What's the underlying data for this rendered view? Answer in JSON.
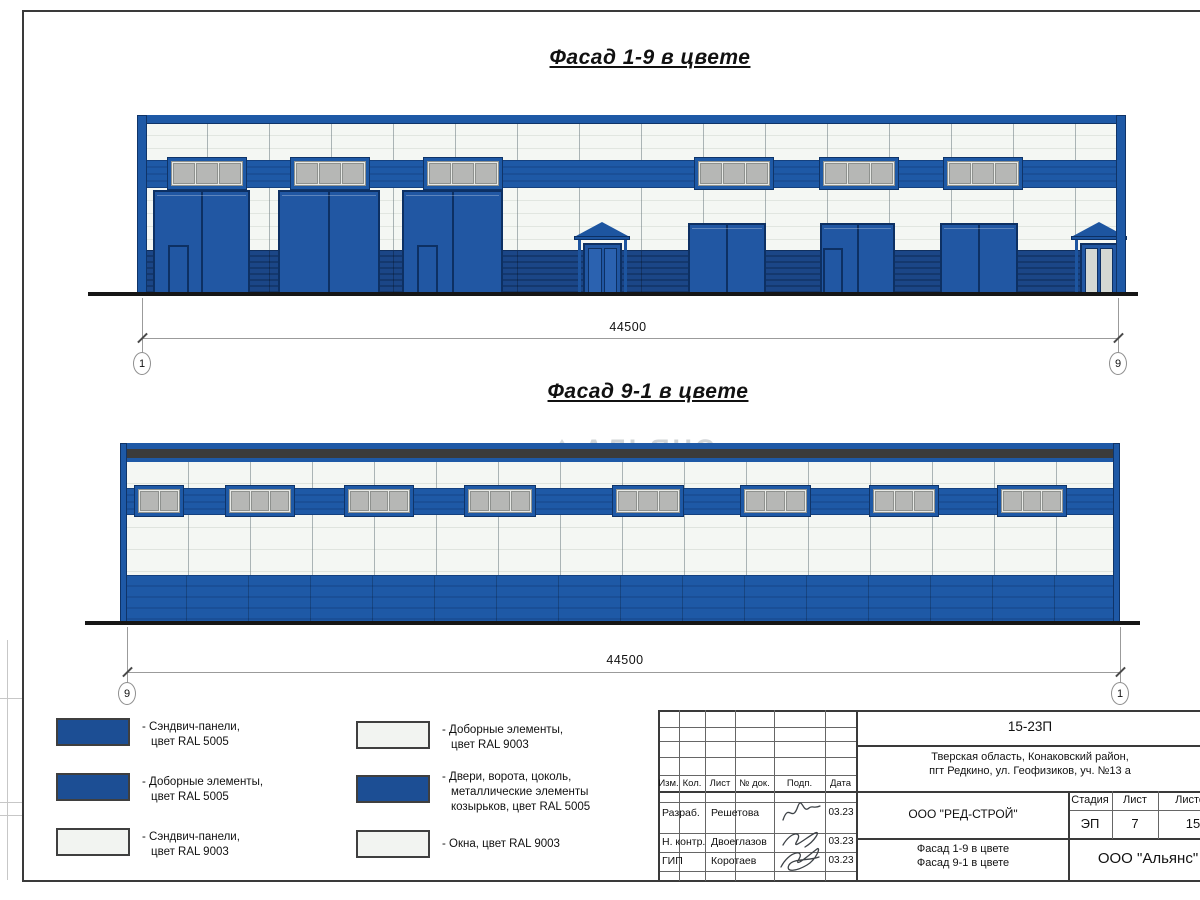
{
  "titles": {
    "facade19": "Фасад 1-9 в цвете",
    "facade91": "Фасад 9-1 в цвете"
  },
  "dimensions": {
    "facade19": {
      "value": "44500",
      "left_axis": "1",
      "right_axis": "9"
    },
    "facade91": {
      "value": "44500",
      "left_axis": "9",
      "right_axis": "1"
    }
  },
  "watermark": {
    "text": "АЛЬЯНС"
  },
  "colors": {
    "facade_blue": "#1e59a6",
    "door_blue": "#2157a3",
    "base_blue": "#1b4687",
    "legend_blue": "#1c4e94",
    "panel_white": "#f2f4f1",
    "window_gray": "#b6b7b5",
    "dark_band": "#3b3b3b"
  },
  "legend": {
    "items": [
      {
        "color": "#1c4e94",
        "lines": [
          "- Сэндвич-панели,",
          "цвет RAL 5005"
        ]
      },
      {
        "color": "#1c4e94",
        "lines": [
          "- Доборные элементы,",
          "цвет RAL 5005"
        ]
      },
      {
        "color": "#f2f4f1",
        "lines": [
          "- Сэндвич-панели,",
          "цвет RAL 9003"
        ]
      },
      {
        "color": "#f2f4f1",
        "lines": [
          "- Доборные элементы,",
          "цвет RAL 9003"
        ]
      },
      {
        "color": "#1c4e94",
        "lines": [
          "- Двери, ворота, цоколь,",
          "металлические элементы",
          "козырьков, цвет RAL 5005"
        ]
      },
      {
        "color": "#f2f4f1",
        "lines": [
          "- Окна, цвет RAL 9003"
        ]
      }
    ]
  },
  "titleblock": {
    "doc_number": "15-23П",
    "address_line1": "Тверская область, Конаковский район,",
    "address_line2": "пгт Редкино, ул. Геофизиков, уч. №13 а",
    "header": {
      "izm": "Изм.",
      "kol": "Кол.",
      "list": "Лист",
      "doc": "№ док.",
      "podp": "Подп.",
      "data": "Дата"
    },
    "rows": [
      {
        "role": "Разраб.",
        "name": "Решетова",
        "date": "03.23"
      },
      {
        "role": "Н. контр.",
        "name": "Двоеглазов",
        "date": "03.23"
      },
      {
        "role": "ГИП",
        "name": "Коротаев",
        "date": "03.23"
      }
    ],
    "developer": "ООО \"РЕД-СТРОЙ\"",
    "stage_label": "Стадия",
    "sheet_label": "Лист",
    "sheets_label": "Листов",
    "stage": "ЭП",
    "sheet": "7",
    "sheets": "15",
    "sheet_title_line1": "Фасад 1-9 в цвете",
    "sheet_title_line2": "Фасад 9-1 в цвете",
    "company": "ООО \"Альянс\""
  }
}
